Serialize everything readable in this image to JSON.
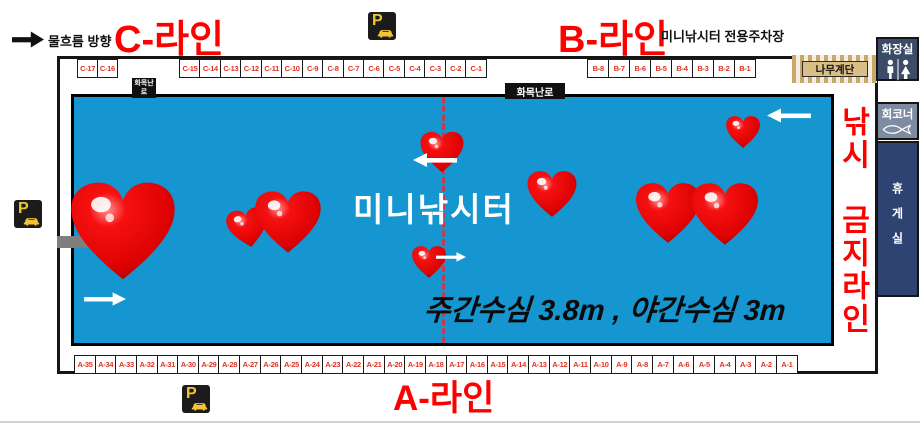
{
  "header": {
    "flow_direction": "물흐름 방향",
    "c_line": "C-라인",
    "b_line": "B-라인",
    "parking_lot": "미니낚시터 전용주차장"
  },
  "footer": {
    "a_line": "A-라인"
  },
  "pond": {
    "title": "미니낚시터",
    "depth_note": "주간수심 3.8m , 야간수심 3m"
  },
  "signs": {
    "wood_stove_small": "화목난로",
    "wood_stove": "화목난로",
    "wooden_stairs": "나무계단",
    "no_fishing_top": "낚시",
    "no_fishing_bottom": "금지라인",
    "parking_symbol": "P"
  },
  "facilities": {
    "restroom": "화장실",
    "sashimi_corner": "회코너",
    "rest_room": "휴게실"
  },
  "spots": {
    "c_left": [
      "C-17",
      "C-16"
    ],
    "c_right": [
      "C-15",
      "C-14",
      "C-13",
      "C-12",
      "C-11",
      "C-10",
      "C-9",
      "C-8",
      "C-7",
      "C-6",
      "C-5",
      "C-4",
      "C-3",
      "C-2",
      "C-1"
    ],
    "b": [
      "B-8",
      "B-7",
      "B-6",
      "B-5",
      "B-4",
      "B-3",
      "B-2",
      "B-1"
    ],
    "a": [
      "A-35",
      "A-34",
      "A-33",
      "A-32",
      "A-31",
      "A-30",
      "A-29",
      "A-28",
      "A-27",
      "A-26",
      "A-25",
      "A-24",
      "A-23",
      "A-22",
      "A-21",
      "A-20",
      "A-19",
      "A-18",
      "A-17",
      "A-16",
      "A-15",
      "A-14",
      "A-13",
      "A-12",
      "A-11",
      "A-10",
      "A-9",
      "A-8",
      "A-7",
      "A-6",
      "A-5",
      "A-4",
      "A-3",
      "A-2",
      "A-1"
    ]
  },
  "colors": {
    "pond_blue": "#1596D0",
    "line_label_red": "#FF0000",
    "spot_text_red": "#E03222",
    "heart_red": "#E60000",
    "restroom_bg": "#3D4C66",
    "sashimi_bg": "#7E8BA1",
    "rest_room_bg": "#2E4372",
    "stairs_tan": "#C9A96B",
    "parking_yellow": "#F2C434"
  }
}
